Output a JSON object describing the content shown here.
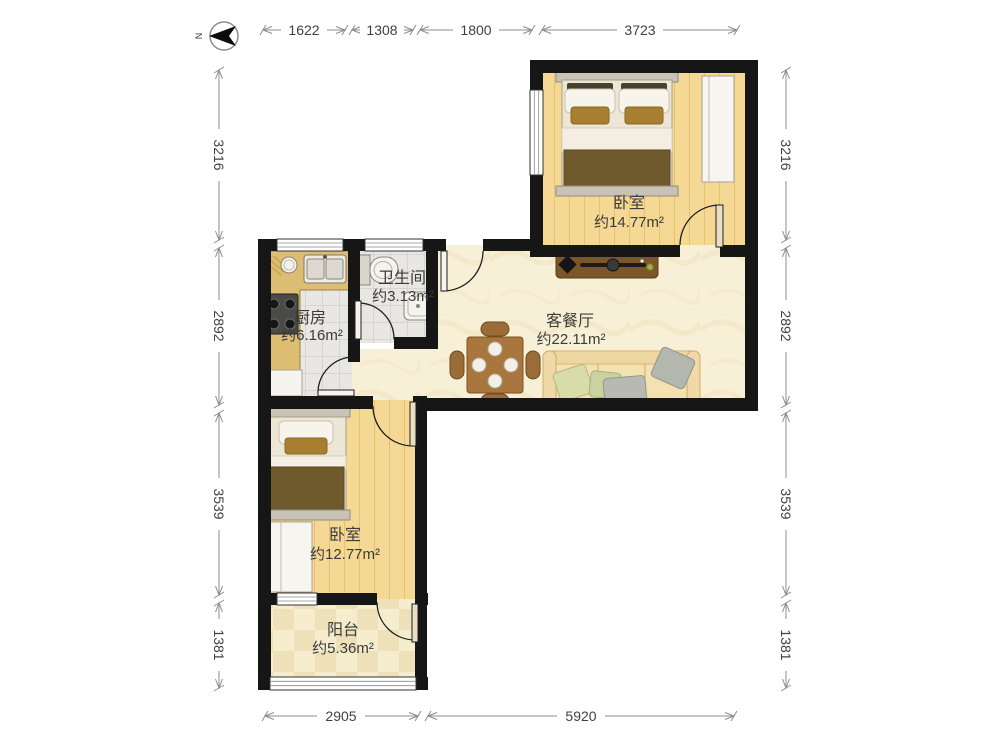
{
  "compass": {
    "label": "N"
  },
  "rooms": {
    "bedroomMain": {
      "name": "卧室",
      "area": "约14.77m²"
    },
    "bathroom": {
      "name": "卫生间",
      "area": "约3.13m²"
    },
    "kitchen": {
      "name": "厨房",
      "area": "约6.16m²"
    },
    "livingDining": {
      "name": "客餐厅",
      "area": "约22.11m²"
    },
    "bedroomSecond": {
      "name": "卧室",
      "area": "约12.77m²"
    },
    "balcony": {
      "name": "阳台",
      "area": "约5.36m²"
    }
  },
  "dimensions": {
    "top": [
      "1622",
      "1308",
      "1800",
      "3723"
    ],
    "left": [
      "3216",
      "2892",
      "3539",
      "1381"
    ],
    "right": [
      "3216",
      "2892",
      "3539",
      "1381"
    ],
    "bottom": [
      "2905",
      "5920"
    ]
  },
  "colors": {
    "wall": "#161616",
    "woodFloor": "#f5d893",
    "tileFloor": "#e8e7e3",
    "marbleFloor": "#f8efd7",
    "balconyFloor": "#f6edcf",
    "counter": "#dcbd72",
    "furnitureBrown": "#a8763e",
    "duvetBrown": "#6f5a2d",
    "sofaCream": "#f4e1b2"
  }
}
